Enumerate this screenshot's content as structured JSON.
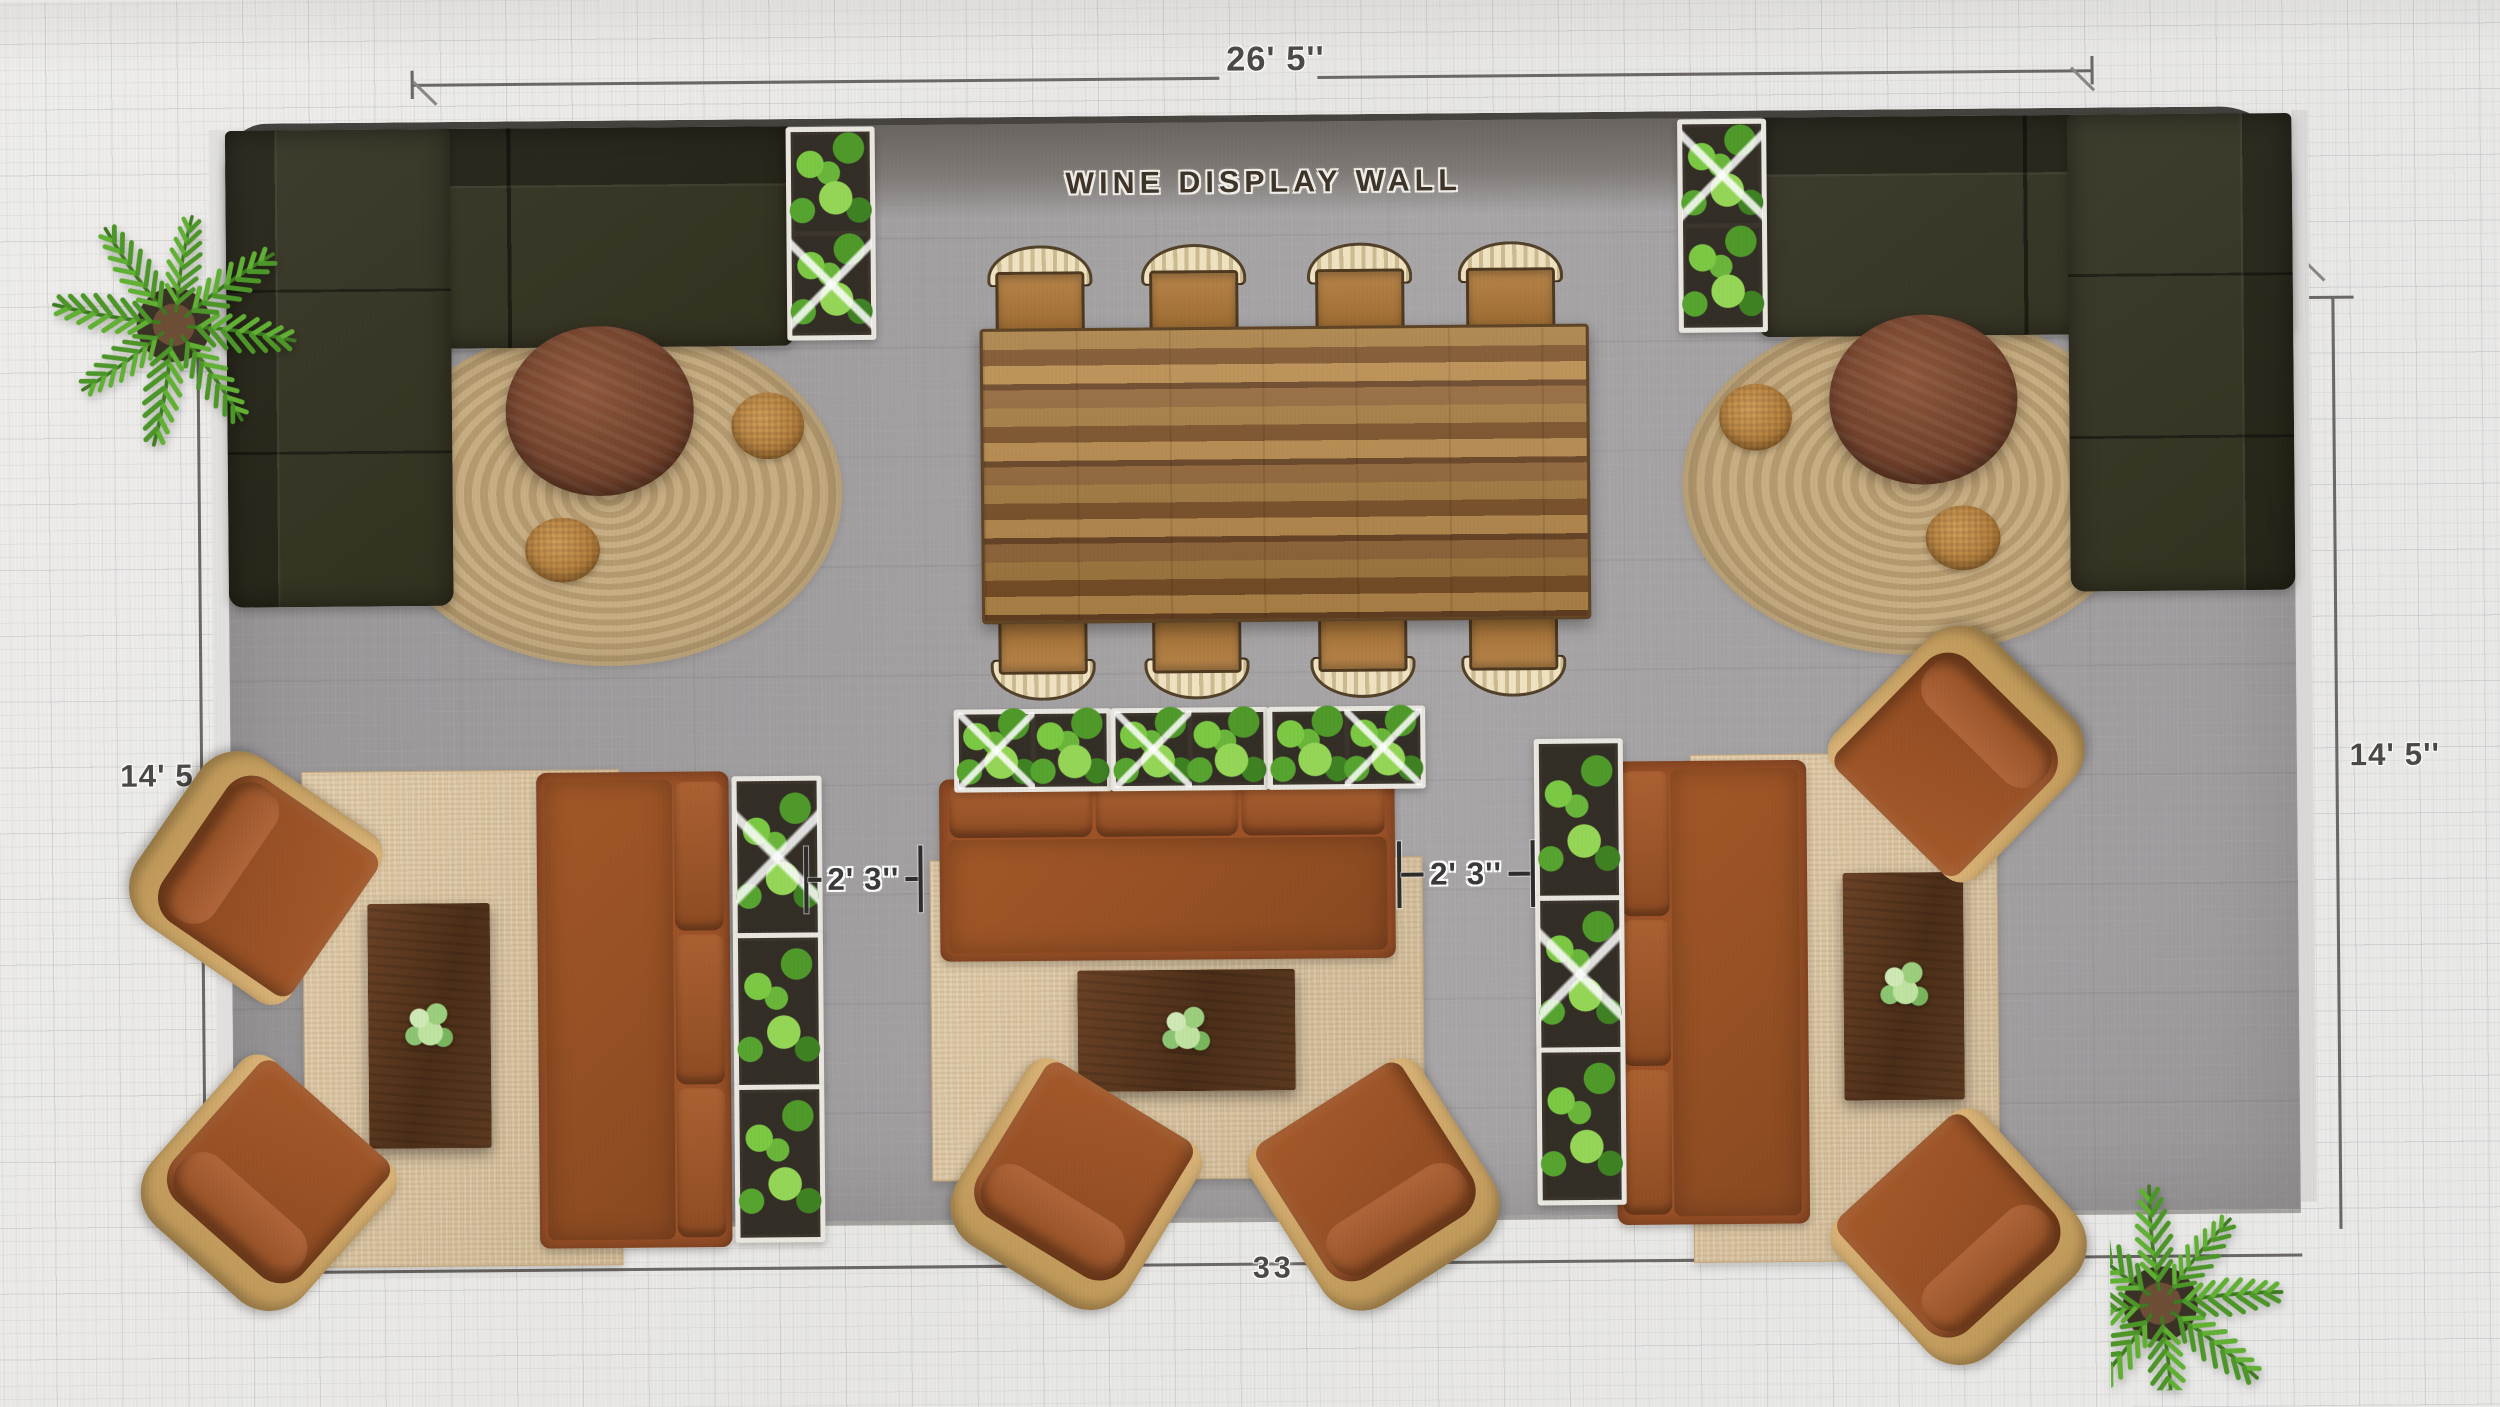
{
  "floor_plan": {
    "wall_label": "WINE DISPLAY WALL",
    "dimensions": {
      "top": "26' 5''",
      "left": "14' 5",
      "right": "14' 5''",
      "gap_left": "2' 3''",
      "gap_right": "2' 3''",
      "bottom": "33"
    },
    "colors": {
      "bg": "#eae9e6",
      "floor": "#9c999b",
      "wall-band": "#7b7672",
      "wall-edge": "#474440",
      "sectional": "#3a382b",
      "jute": "#c3a97e",
      "wood": "#7c4a31",
      "walnut": "#5c3a21",
      "rust": "#9d5228",
      "pouf": "#c38d49",
      "rug-beige": "#dcc49e",
      "frame-tan": "#cfa96c",
      "seat-tan": "#b07c3f",
      "back-cream": "#ecdcb8",
      "planter-white": "#eae7e0",
      "soil": "#3b352c",
      "green-1": "#7cc944",
      "green-2": "#4f9a2a",
      "green-3": "#95d656",
      "dim-text": "#4c4947"
    }
  }
}
